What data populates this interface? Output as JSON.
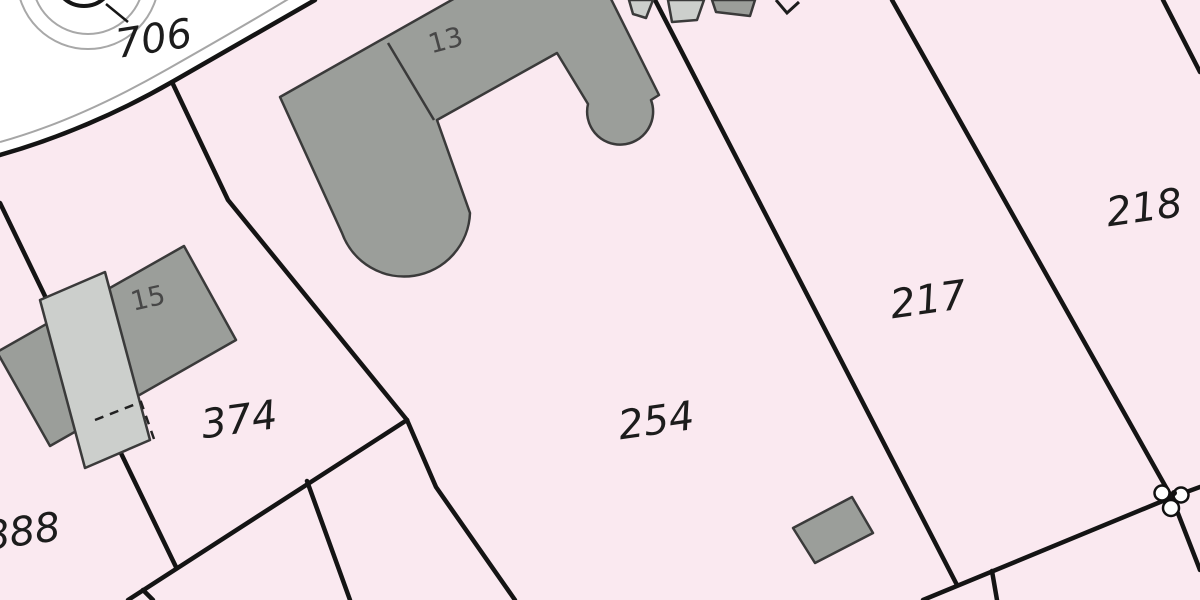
{
  "map": {
    "kind": "cadastral parcel map",
    "colors": {
      "parcel_fill": "#fae9f0",
      "road_fill": "#ffffff",
      "boundary_line": "#141414",
      "road_edge_line": "#a6a6a6",
      "building_fill_dark": "#9b9e9a",
      "building_fill_light": "#cccfcc",
      "building_outline": "#3a3a3a",
      "parcel_label_color": "#1c1c1c",
      "building_label_color": "#474747"
    },
    "labels": {
      "parcels": {
        "p706": "706",
        "p374": "374",
        "p888": "888",
        "p254": "254",
        "p217": "217",
        "p218": "218"
      },
      "buildings": {
        "b13": "13",
        "b15": "15"
      }
    },
    "icons": {
      "survey_marker": "survey-point-marker",
      "roundabout": "concentric-circles-feature"
    }
  }
}
